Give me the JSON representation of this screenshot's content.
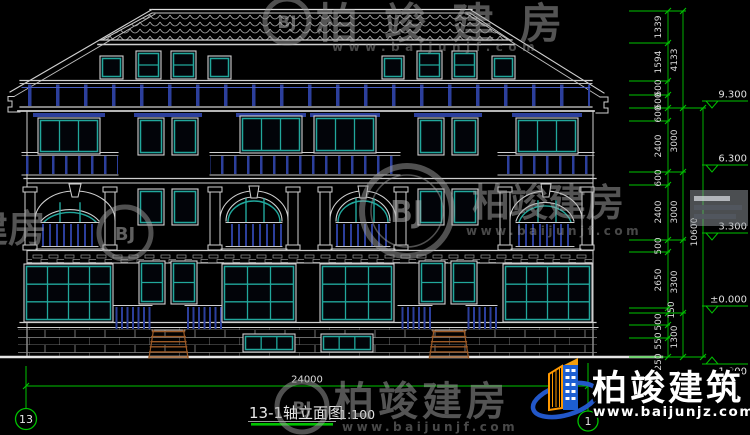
{
  "drawing": {
    "title": "13-1轴立面图",
    "scale": "1:100",
    "grid_bubble_left": "13",
    "grid_bubble_right": "1",
    "total_width_dim": "24000"
  },
  "dim_col1": [
    "1339",
    "1594",
    "600",
    "600",
    "600",
    "2400",
    "600",
    "2400",
    "500",
    "2650",
    "150",
    "500",
    "550",
    "250"
  ],
  "dim_col2": [
    "4133",
    "3000",
    "3000",
    "3300",
    "1300"
  ],
  "dim_col3": [
    "10600"
  ],
  "levels": [
    "9.300",
    "6.300",
    "3.300",
    "±0.000",
    "-1.300"
  ],
  "watermark": {
    "brand": "柏竣建房",
    "site": "www.baijunjf.com",
    "monogram": "BJ"
  },
  "logo": {
    "brand": "柏竣建筑",
    "site": "www.baijunjz.com"
  },
  "colors": {
    "background": "#000000",
    "line_white": "#d0d0d0",
    "window_teal": "#21a79c",
    "railing_navy": "#2c3f9c",
    "dimension_green": "#00c300",
    "stair_brown": "#9c5a26",
    "logo_blue": "#1d5fd2",
    "logo_orange": "#ff9800"
  }
}
